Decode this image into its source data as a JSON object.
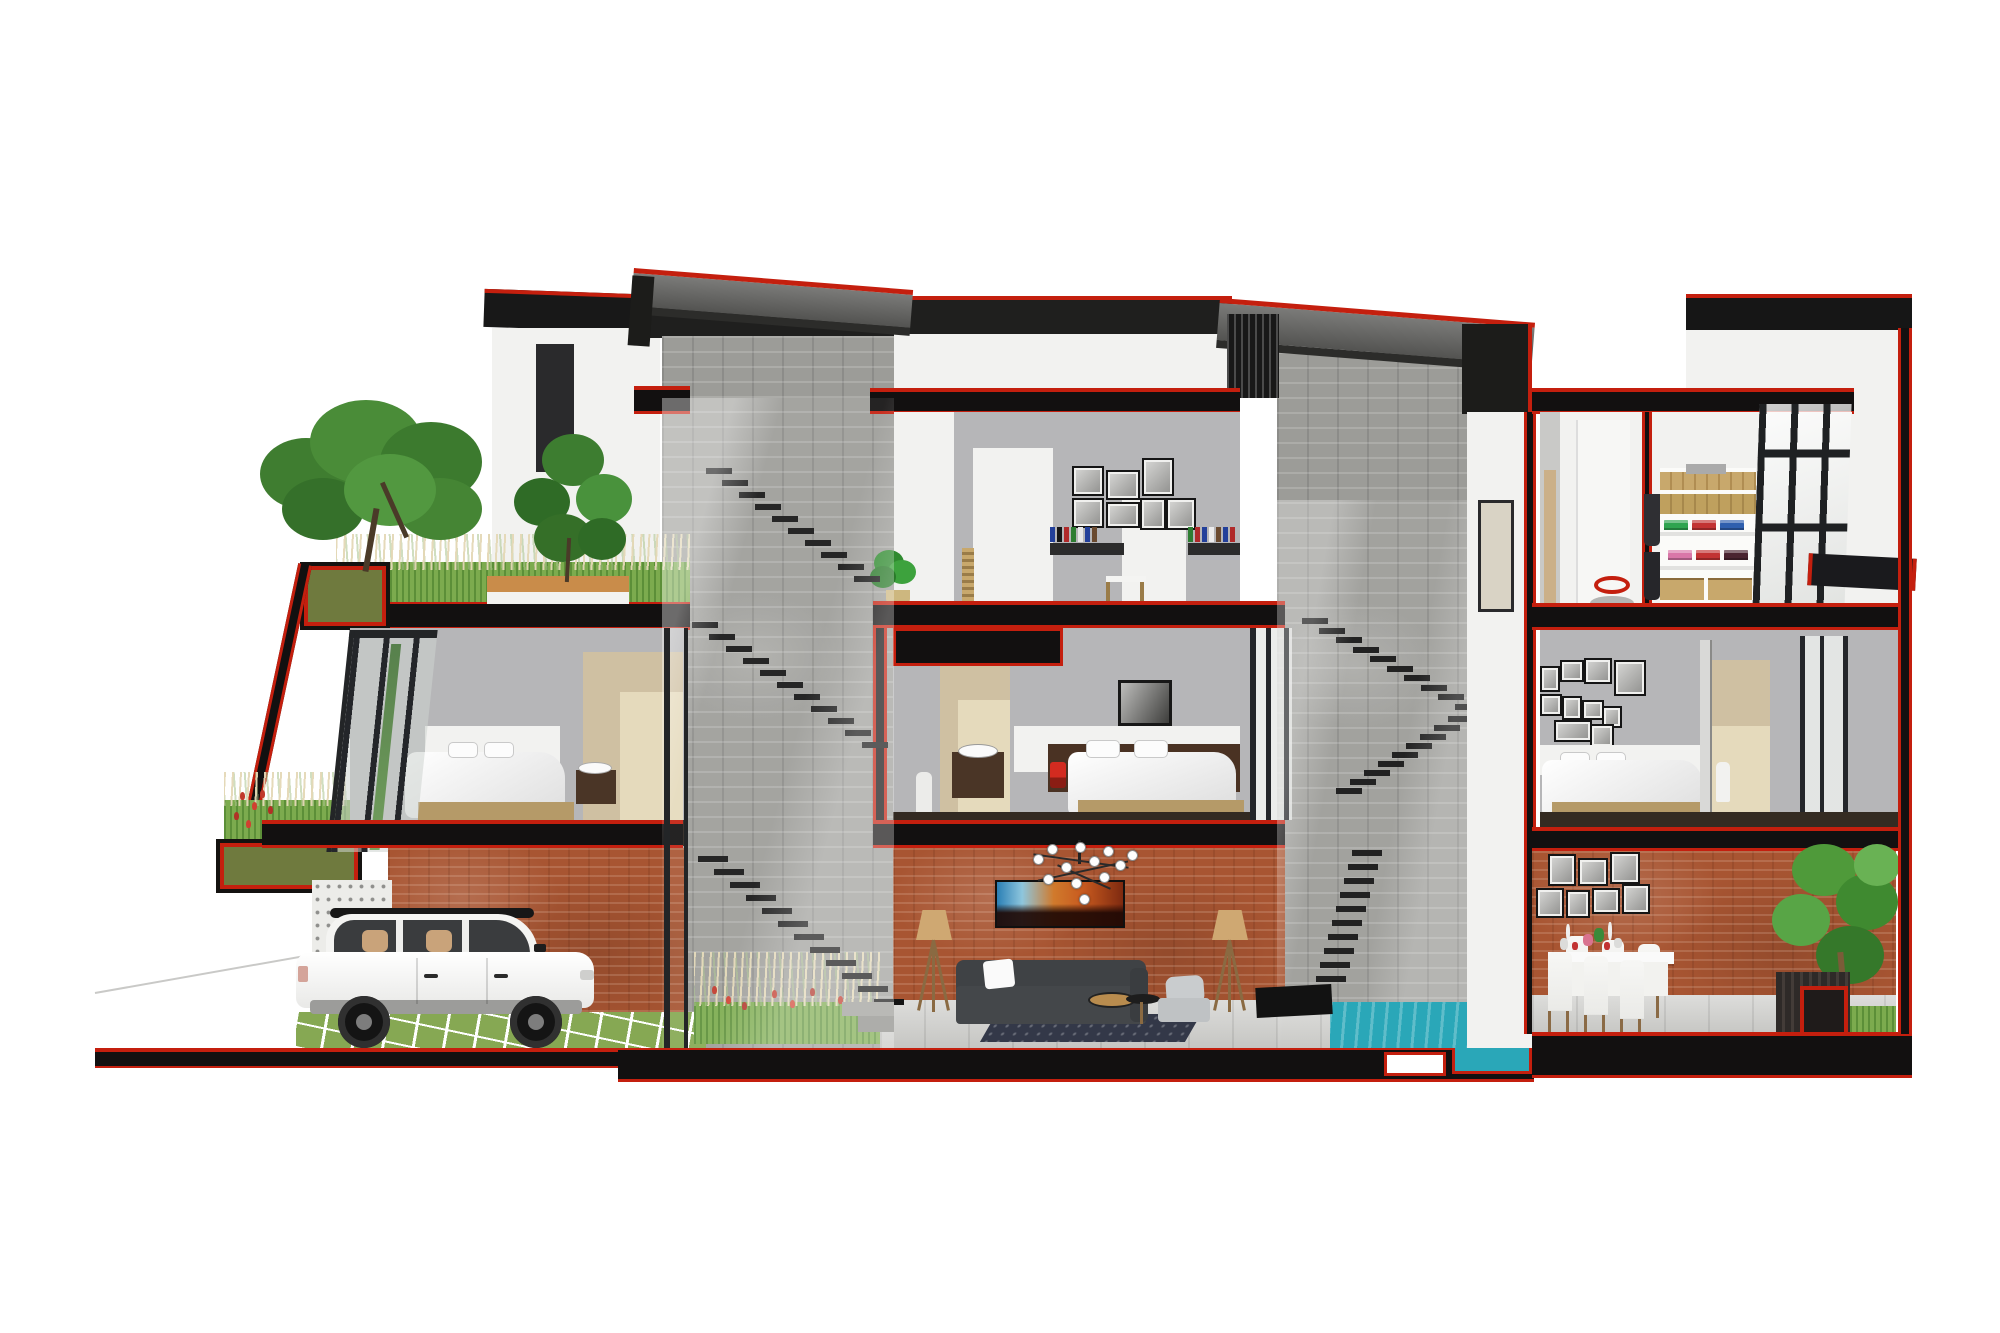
{
  "palette": {
    "cut-red": "#c41f0e",
    "slab-black": "#121010",
    "brick": "#a85532",
    "stone": "#9c9c98",
    "wall-gray": "#b6b6b8",
    "tile-beige": "#cfc0a2",
    "tile-light": "#e5dabc",
    "wood-tan": "#b59a68",
    "wood-dark": "#4a3526",
    "grass": "#7aa849",
    "olive": "#6f7a3e",
    "pool": "#2aa7b8",
    "sofa": "#44474a",
    "rug": "#333848",
    "lamp-tan": "#cfa872",
    "car-white": "#f4f4f3",
    "lamp-red": "#d22b20"
  },
  "scene": {
    "stairs": {
      "core_a_upper": [
        {
          "x": 706,
          "y": 468
        },
        {
          "x": 722,
          "y": 480
        },
        {
          "x": 739,
          "y": 492
        },
        {
          "x": 755,
          "y": 504
        },
        {
          "x": 772,
          "y": 516
        },
        {
          "x": 788,
          "y": 528
        },
        {
          "x": 805,
          "y": 540
        },
        {
          "x": 821,
          "y": 552
        },
        {
          "x": 838,
          "y": 564
        },
        {
          "x": 854,
          "y": 576
        }
      ],
      "core_a_mid": [
        {
          "x": 692,
          "y": 622
        },
        {
          "x": 709,
          "y": 634
        },
        {
          "x": 726,
          "y": 646
        },
        {
          "x": 743,
          "y": 658
        },
        {
          "x": 760,
          "y": 670
        },
        {
          "x": 777,
          "y": 682
        },
        {
          "x": 794,
          "y": 694
        },
        {
          "x": 811,
          "y": 706
        },
        {
          "x": 828,
          "y": 718
        },
        {
          "x": 845,
          "y": 730
        },
        {
          "x": 862,
          "y": 742
        }
      ],
      "core_a_lower": [
        {
          "x": 698,
          "y": 856
        },
        {
          "x": 714,
          "y": 869
        },
        {
          "x": 730,
          "y": 882
        },
        {
          "x": 746,
          "y": 895
        },
        {
          "x": 762,
          "y": 908
        },
        {
          "x": 778,
          "y": 921
        },
        {
          "x": 794,
          "y": 934
        },
        {
          "x": 810,
          "y": 947
        },
        {
          "x": 826,
          "y": 960
        },
        {
          "x": 842,
          "y": 973
        },
        {
          "x": 858,
          "y": 986
        },
        {
          "x": 874,
          "y": 999
        }
      ],
      "core_b_run1": [
        {
          "x": 1302,
          "y": 618
        },
        {
          "x": 1319,
          "y": 628
        },
        {
          "x": 1336,
          "y": 637
        },
        {
          "x": 1353,
          "y": 647
        },
        {
          "x": 1370,
          "y": 656
        },
        {
          "x": 1387,
          "y": 666
        },
        {
          "x": 1404,
          "y": 675
        },
        {
          "x": 1421,
          "y": 685
        },
        {
          "x": 1438,
          "y": 694
        },
        {
          "x": 1455,
          "y": 704
        }
      ],
      "core_b_run2": [
        {
          "x": 1448,
          "y": 716
        },
        {
          "x": 1434,
          "y": 725
        },
        {
          "x": 1420,
          "y": 734
        },
        {
          "x": 1406,
          "y": 743
        },
        {
          "x": 1392,
          "y": 752
        },
        {
          "x": 1378,
          "y": 761
        },
        {
          "x": 1364,
          "y": 770
        },
        {
          "x": 1350,
          "y": 779
        },
        {
          "x": 1336,
          "y": 788
        }
      ],
      "core_b_run3": [
        {
          "x": 1352,
          "y": 850
        },
        {
          "x": 1348,
          "y": 864
        },
        {
          "x": 1344,
          "y": 878
        },
        {
          "x": 1340,
          "y": 892
        },
        {
          "x": 1336,
          "y": 906
        },
        {
          "x": 1332,
          "y": 920
        },
        {
          "x": 1328,
          "y": 934
        },
        {
          "x": 1324,
          "y": 948
        },
        {
          "x": 1320,
          "y": 962
        },
        {
          "x": 1316,
          "y": 976
        }
      ]
    },
    "galleries": {
      "studio": [
        {
          "x": 1072,
          "y": 466,
          "w": 28,
          "h": 26
        },
        {
          "x": 1106,
          "y": 470,
          "w": 30,
          "h": 26
        },
        {
          "x": 1142,
          "y": 458,
          "w": 28,
          "h": 34
        },
        {
          "x": 1072,
          "y": 498,
          "w": 28,
          "h": 26
        },
        {
          "x": 1106,
          "y": 502,
          "w": 30,
          "h": 22
        },
        {
          "x": 1140,
          "y": 498,
          "w": 22,
          "h": 28
        },
        {
          "x": 1166,
          "y": 498,
          "w": 26,
          "h": 28
        }
      ],
      "right_bedroom": [
        {
          "x": 1540,
          "y": 666,
          "w": 16,
          "h": 22
        },
        {
          "x": 1560,
          "y": 660,
          "w": 20,
          "h": 18
        },
        {
          "x": 1584,
          "y": 658,
          "w": 24,
          "h": 22
        },
        {
          "x": 1614,
          "y": 660,
          "w": 28,
          "h": 32
        },
        {
          "x": 1540,
          "y": 694,
          "w": 18,
          "h": 18
        },
        {
          "x": 1562,
          "y": 696,
          "w": 16,
          "h": 20
        },
        {
          "x": 1582,
          "y": 700,
          "w": 18,
          "h": 16
        },
        {
          "x": 1554,
          "y": 720,
          "w": 34,
          "h": 18
        },
        {
          "x": 1602,
          "y": 706,
          "w": 16,
          "h": 18
        },
        {
          "x": 1590,
          "y": 724,
          "w": 20,
          "h": 20
        }
      ],
      "dining": [
        {
          "x": 1548,
          "y": 854,
          "w": 24,
          "h": 28
        },
        {
          "x": 1578,
          "y": 858,
          "w": 26,
          "h": 24
        },
        {
          "x": 1610,
          "y": 852,
          "w": 26,
          "h": 28
        },
        {
          "x": 1536,
          "y": 888,
          "w": 24,
          "h": 26
        },
        {
          "x": 1566,
          "y": 890,
          "w": 20,
          "h": 24
        },
        {
          "x": 1592,
          "y": 888,
          "w": 24,
          "h": 22
        },
        {
          "x": 1622,
          "y": 884,
          "w": 24,
          "h": 26
        }
      ]
    },
    "books": {
      "left": [
        "#23409a",
        "#161616",
        "#b02a2a",
        "#2e7d32",
        "#e8e8e8",
        "#23409a",
        "#6a4a2f"
      ],
      "right": [
        "#2e7d32",
        "#b02a2a",
        "#23409a",
        "#ececec",
        "#6a4a2f",
        "#23409a",
        "#b02a2a",
        "#161616",
        "#2e7d32"
      ]
    },
    "closet": {
      "row1": [
        "#2fa44f",
        "#c23333",
        "#2f5fae",
        "#d87a33"
      ],
      "row2": [
        "#d977a8",
        "#c23333",
        "#4a2430"
      ]
    },
    "chandelier_bulbs": [
      {
        "x": 18,
        "y": 14
      },
      {
        "x": 32,
        "y": 4
      },
      {
        "x": 46,
        "y": 22
      },
      {
        "x": 60,
        "y": 2
      },
      {
        "x": 74,
        "y": 16
      },
      {
        "x": 88,
        "y": 6
      },
      {
        "x": 100,
        "y": 20
      },
      {
        "x": 112,
        "y": 10
      },
      {
        "x": 28,
        "y": 34
      },
      {
        "x": 56,
        "y": 38
      },
      {
        "x": 84,
        "y": 32
      },
      {
        "x": 64,
        "y": 54
      }
    ],
    "trees": {
      "plumeria": [
        {
          "x": 8,
          "y": 52,
          "w": 92,
          "h": 72,
          "c": "#3f7d30"
        },
        {
          "x": 58,
          "y": 14,
          "w": 112,
          "h": 84,
          "c": "#4a8c38"
        },
        {
          "x": 128,
          "y": 36,
          "w": 102,
          "h": 80,
          "c": "#3c7a2e"
        },
        {
          "x": 30,
          "y": 92,
          "w": 82,
          "h": 62,
          "c": "#35702a"
        },
        {
          "x": 146,
          "y": 92,
          "w": 84,
          "h": 62,
          "c": "#458534"
        },
        {
          "x": 92,
          "y": 68,
          "w": 92,
          "h": 72,
          "c": "#529840"
        }
      ],
      "conifer": [
        {
          "x": 30,
          "y": 4,
          "w": 62,
          "h": 52,
          "c": "#3d7d30"
        },
        {
          "x": 2,
          "y": 48,
          "w": 56,
          "h": 48,
          "c": "#2f6b26"
        },
        {
          "x": 64,
          "y": 44,
          "w": 56,
          "h": 50,
          "c": "#49923c"
        },
        {
          "x": 22,
          "y": 84,
          "w": 58,
          "h": 48,
          "c": "#356f28"
        },
        {
          "x": 66,
          "y": 88,
          "w": 48,
          "h": 42,
          "c": "#2f6b26"
        }
      ],
      "courtyard": [
        {
          "x": 28,
          "y": 6,
          "w": 64,
          "h": 52,
          "c": "#4f9a3a"
        },
        {
          "x": 72,
          "y": 36,
          "w": 62,
          "h": 56,
          "c": "#3f8a30"
        },
        {
          "x": 8,
          "y": 56,
          "w": 58,
          "h": 52,
          "c": "#58a546"
        },
        {
          "x": 52,
          "y": 88,
          "w": 68,
          "h": 58,
          "c": "#35782a"
        },
        {
          "x": 90,
          "y": 6,
          "w": 46,
          "h": 42,
          "c": "#69b254"
        }
      ],
      "studio_plant": [
        {
          "x": 4,
          "y": 4,
          "w": 30,
          "h": 26,
          "c": "#2f8a2f"
        },
        {
          "x": 18,
          "y": 14,
          "w": 28,
          "h": 24,
          "c": "#3da23d"
        },
        {
          "x": 0,
          "y": 20,
          "w": 26,
          "h": 22,
          "c": "#2a7a2a"
        }
      ]
    },
    "flowers": {
      "roof_planter": [
        {
          "x": 240,
          "y": 792,
          "c": "#c0392b"
        },
        {
          "x": 252,
          "y": 802,
          "c": "#d04030"
        },
        {
          "x": 234,
          "y": 812,
          "c": "#b03226"
        },
        {
          "x": 260,
          "y": 790,
          "c": "#c0392b"
        },
        {
          "x": 246,
          "y": 820,
          "c": "#d04030"
        },
        {
          "x": 268,
          "y": 806,
          "c": "#b03226"
        }
      ],
      "indoor_garden": [
        {
          "x": 712,
          "y": 986,
          "c": "#c0392b"
        },
        {
          "x": 726,
          "y": 996,
          "c": "#d04030"
        },
        {
          "x": 742,
          "y": 1002,
          "c": "#b03226"
        },
        {
          "x": 772,
          "y": 990,
          "c": "#c0392b"
        },
        {
          "x": 790,
          "y": 1000,
          "c": "#d04030"
        },
        {
          "x": 810,
          "y": 988,
          "c": "#b03226"
        },
        {
          "x": 838,
          "y": 996,
          "c": "#c0392b"
        },
        {
          "x": 854,
          "y": 1004,
          "c": "#d04030"
        }
      ]
    },
    "dining": {
      "chairs_near": [
        {
          "x": 1548,
          "y": 952
        },
        {
          "x": 1584,
          "y": 956
        },
        {
          "x": 1620,
          "y": 960
        }
      ],
      "chairs_far": [
        {
          "x": 1566,
          "y": 936
        },
        {
          "x": 1602,
          "y": 940
        },
        {
          "x": 1638,
          "y": 944
        }
      ],
      "table_items": [
        {
          "x": 1560,
          "y": 938,
          "w": 8,
          "h": 12,
          "c": "#dcdcda"
        },
        {
          "x": 1572,
          "y": 942,
          "w": 6,
          "h": 8,
          "c": "#c23333"
        },
        {
          "x": 1583,
          "y": 934,
          "w": 10,
          "h": 12,
          "c": "#d9738f"
        },
        {
          "x": 1594,
          "y": 928,
          "w": 10,
          "h": 14,
          "c": "#3a8a3a"
        },
        {
          "x": 1604,
          "y": 942,
          "w": 6,
          "h": 8,
          "c": "#c23333"
        },
        {
          "x": 1614,
          "y": 938,
          "w": 8,
          "h": 10,
          "c": "#dcdcda"
        },
        {
          "x": 1566,
          "y": 924,
          "w": 4,
          "h": 16,
          "c": "#efefef"
        },
        {
          "x": 1608,
          "y": 922,
          "w": 4,
          "h": 18,
          "c": "#efefef"
        }
      ]
    }
  }
}
